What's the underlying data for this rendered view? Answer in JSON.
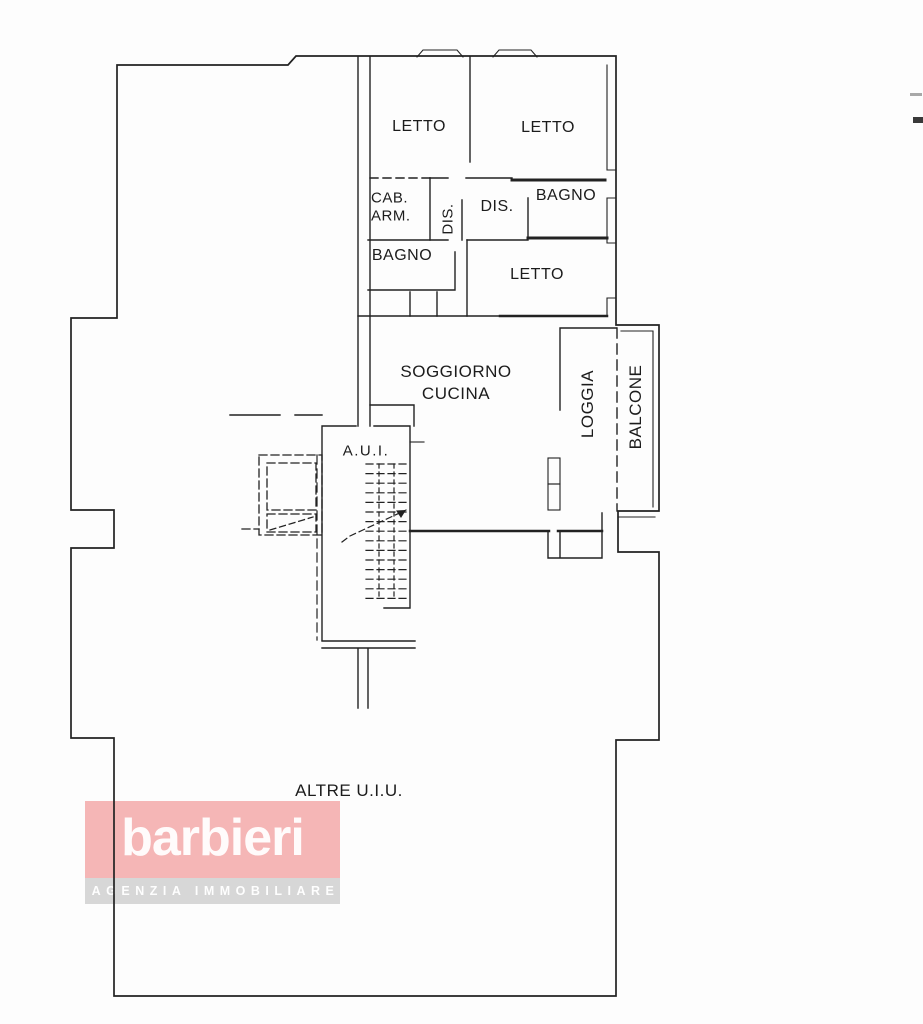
{
  "document": {
    "type": "floor-plan",
    "language": "it"
  },
  "labels": {
    "letto1": "LETTO",
    "letto2": "LETTO",
    "cab_arm_line1": "CAB.",
    "cab_arm_line2": "ARM.",
    "dis_corridor": "DIS.",
    "dis_room": "DIS.",
    "bagno_top": "BAGNO",
    "bagno_left": "BAGNO",
    "letto3": "LETTO",
    "soggiorno_line1": "SOGGIORNO",
    "soggiorno_line2": "CUCINA",
    "loggia": "LOGGIA",
    "balcone": "BALCONE",
    "aui": "A.U.I.",
    "altre_uiu": "ALTRE U.I.U."
  },
  "logo": {
    "brand": "barbieri",
    "tagline": "AGENZIA IMMOBILIARE",
    "text_color": "#ffffff"
  },
  "colors": {
    "paper": "#fdfdfd",
    "line": "#222222",
    "brand_bg": "rgba(236,95,95,0.45)",
    "tagline_bg": "rgba(0,0,0,0.15)"
  }
}
